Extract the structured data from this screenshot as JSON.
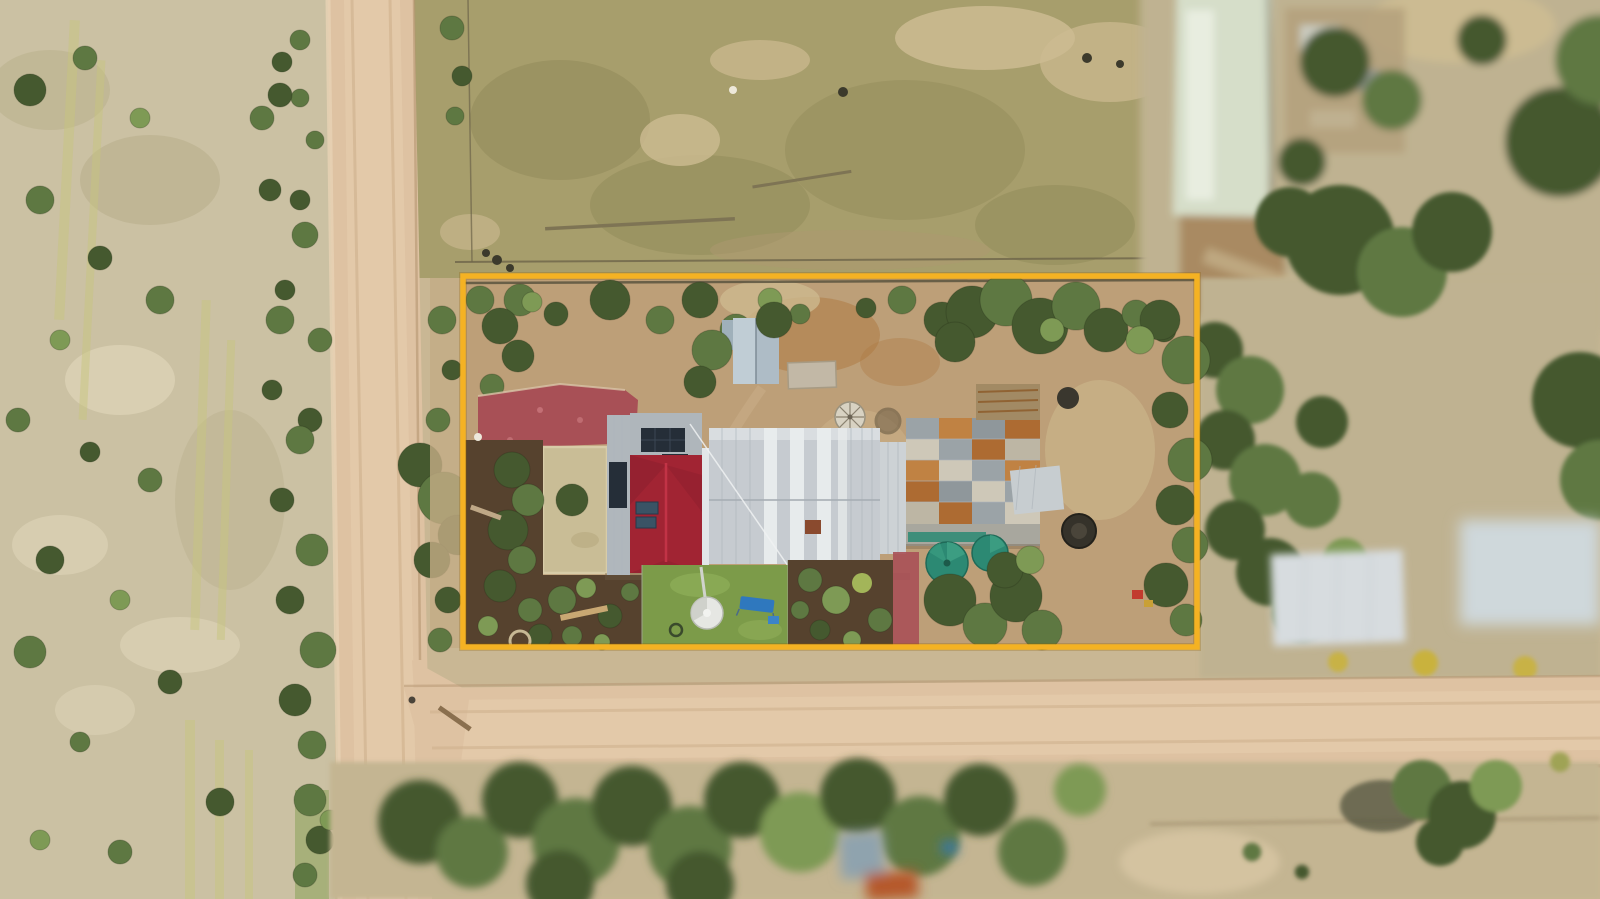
{
  "meta": {
    "type": "aerial-drone-photograph",
    "description": "Top-down aerial photograph of a rural lot highlighted with a yellow boundary outline: red-and-silver roofed farmhouse with solar panels, rusty sheds, teal rain tanks, gardens and lawn inside the lot; dirt roads, scrub paddocks and blurred neighbouring sheds and trees around it.",
    "width_px": 1600,
    "height_px": 899
  },
  "palette": {
    "boundary": "#F4B223",
    "boundary_halo": "#8a5c00",
    "sand_base": "#C9B794",
    "field_left": "#CBC1A3",
    "field_patch_light": "#DCD2B5",
    "field_patch_dark": "#B5AC87",
    "yellow_streak": "#C6C47E",
    "paddock": "#A79E6C",
    "paddock_dark": "#8F8757",
    "paddock_pale": "#CDBB92",
    "scrub_right": "#BFB291",
    "road": "#DEC2A2",
    "road_center": "#E7CFAF",
    "road_edge": "#B49471",
    "tree_dark": "#45592F",
    "tree_mid": "#5E7842",
    "tree_light": "#7E9A55",
    "lawn": "#7C9B49",
    "lawn_light": "#93B25C",
    "dry_lawn": "#C9BD96",
    "mulch": "#56422E",
    "paving_red": "#A85056",
    "dirt_yard": "#BD9F78",
    "dirt_orange": "#AF7A44",
    "roof_white": "#C6CBD0",
    "roof_white_bright": "#E9ECED",
    "roof_gray_wing": "#B0B7BC",
    "roof_red": "#A12433",
    "roof_red_ridge": "#C23346",
    "roof_red_dark": "#8C1F2D",
    "solar_panel": "#252E38",
    "skylight": "#3A5365",
    "rust": "#AD6B32",
    "rust_light": "#C08243",
    "shed_galv": "#AEBCC6",
    "shed_pale": "#D7DCDF",
    "tank_teal": "#2C8973",
    "tank_teal_light": "#3EA084",
    "tank_white": "#E6E7E3",
    "trampoline_blue": "#2F78BE",
    "building_blue": "#8FA3AE",
    "building_orange": "#B5592B",
    "fence": "#6E654A",
    "flower_yellow": "#C9B23E"
  },
  "scene": {
    "boundary_px": {
      "x": 463,
      "y": 276,
      "w": 734,
      "h": 371
    },
    "features": [
      "property-boundary-overlay",
      "vertical-dirt-road",
      "horizontal-dirt-road",
      "road-junction",
      "left-scrub-field",
      "north-paddock",
      "northeast-neighbour-shed",
      "farmhouse-white-roof",
      "farmhouse-red-roof",
      "solar-panels",
      "garden-shed",
      "rusty-sheds",
      "teal-water-tanks",
      "white-water-tank",
      "red-gravel-paving",
      "dry-lawn-square",
      "green-lawn",
      "mulch-gardens",
      "trampoline",
      "windmill-disc",
      "fire-pit",
      "east-neighbour-sheds",
      "south-tree-belt",
      "south-neighbour-buildings",
      "southeast-scrub",
      "roadside-shrubs"
    ]
  }
}
